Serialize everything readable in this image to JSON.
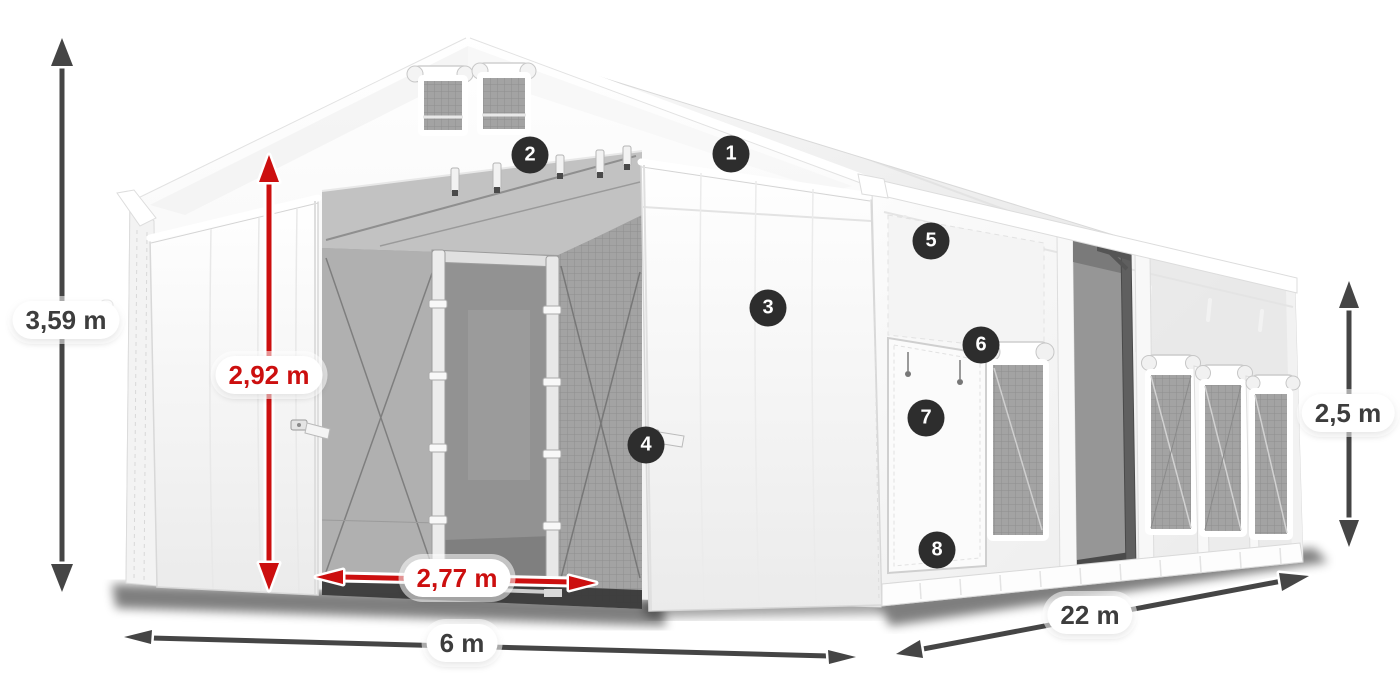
{
  "diagram": {
    "subject": "tent-dimension-diagram",
    "dimensions": {
      "total_height": {
        "label": "3,59 m",
        "style": "gray"
      },
      "entrance_height": {
        "label": "2,92 m",
        "style": "red"
      },
      "entrance_width": {
        "label": "2,77 m",
        "style": "red"
      },
      "width": {
        "label": "6 m",
        "style": "gray"
      },
      "length": {
        "label": "22 m",
        "style": "gray"
      },
      "wall_height": {
        "label": "2,5 m",
        "style": "gray"
      }
    },
    "callouts": [
      {
        "number": "1"
      },
      {
        "number": "2"
      },
      {
        "number": "3"
      },
      {
        "number": "4"
      },
      {
        "number": "5"
      },
      {
        "number": "6"
      },
      {
        "number": "7"
      },
      {
        "number": "8"
      }
    ],
    "colors": {
      "dimension_red": "#cc0f0f",
      "dimension_gray": "#454545",
      "badge_background": "#2d2d2d",
      "badge_text": "#ffffff",
      "pill_background": "#ffffff",
      "pill_text_gray": "#3d3d3d",
      "tent_fabric": "#ffffff",
      "interior_gray": "#a2a2a2"
    }
  }
}
